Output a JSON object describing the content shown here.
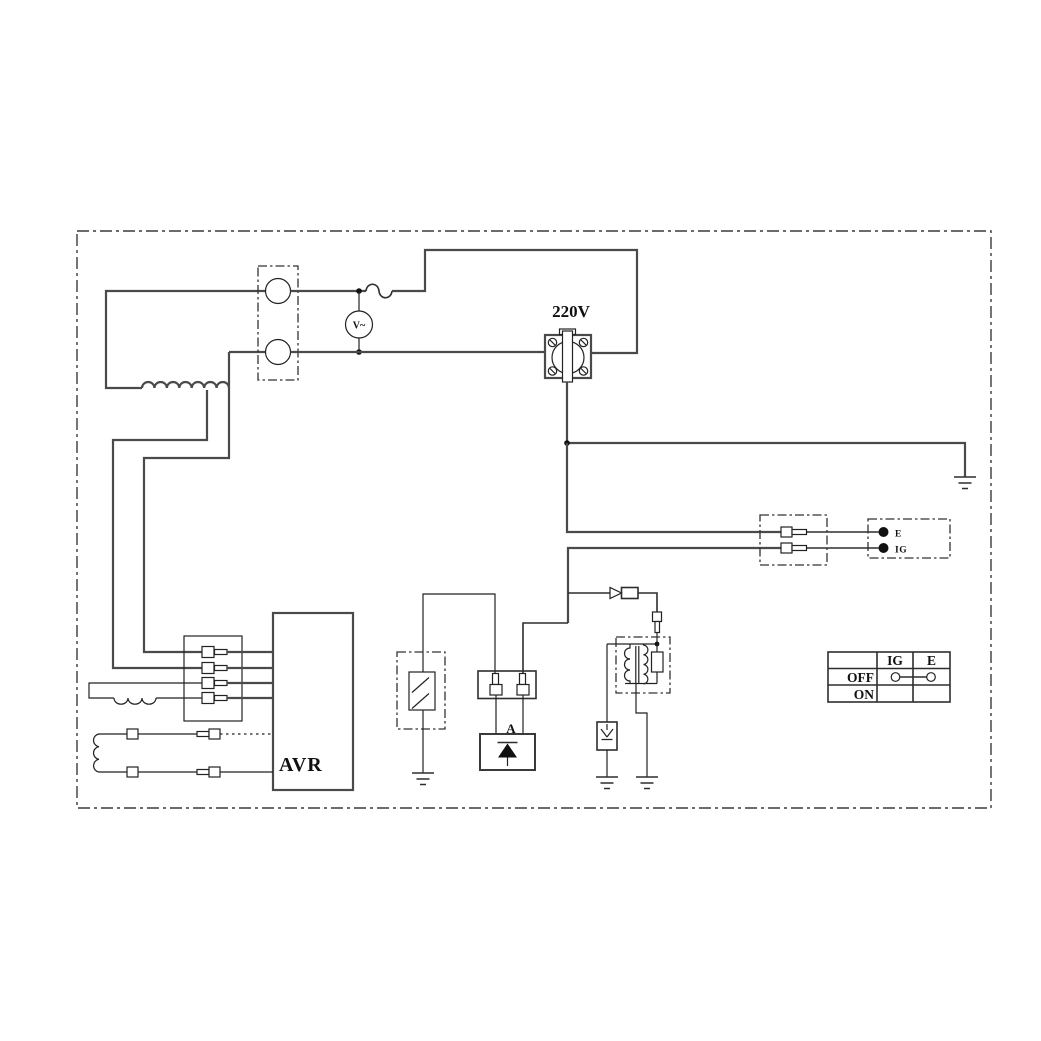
{
  "diagram": {
    "type": "generator-wiring-diagram",
    "colors": {
      "background": "#ffffff",
      "wire": "#4a4a4a",
      "thin_line": "#222222",
      "text": "#101010"
    },
    "labels": {
      "outlet_voltage": "220V",
      "voltmeter": "V~",
      "avr": "AVR",
      "diode_unit": "A"
    },
    "remote_terminal_box": {
      "terminals": [
        {
          "label": "E"
        },
        {
          "label": "IG"
        }
      ]
    },
    "engine_switch_table": {
      "columns": [
        "IG",
        "E"
      ],
      "rows": [
        {
          "label": "OFF",
          "connected": true
        },
        {
          "label": "ON",
          "connected": false
        }
      ]
    }
  }
}
